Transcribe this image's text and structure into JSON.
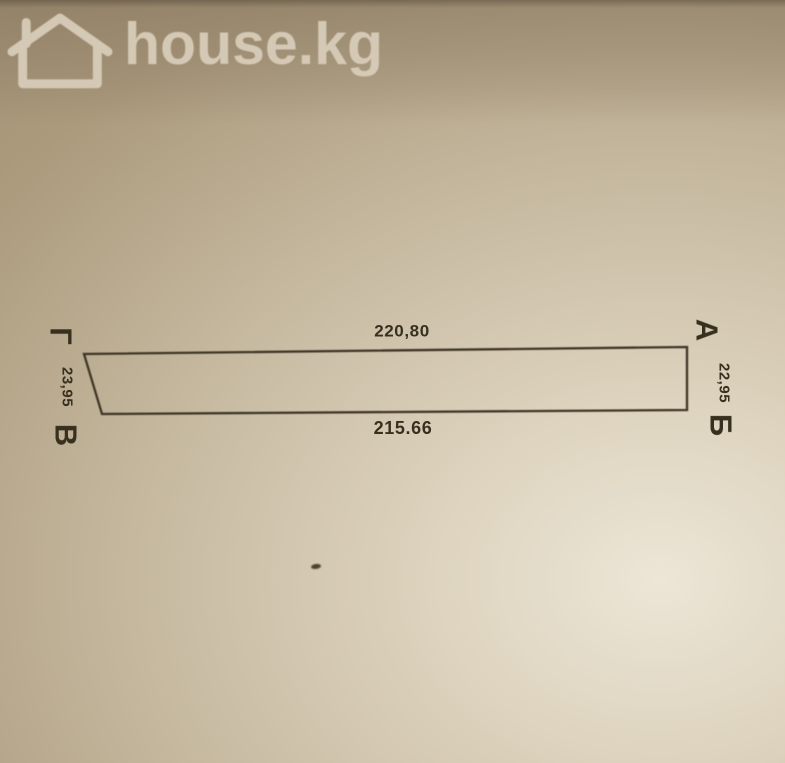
{
  "watermark": {
    "brand": "house.kg",
    "icon": "house-outline-icon",
    "color": "#d9cebb"
  },
  "diagram": {
    "type": "land-plot-survey-sketch",
    "line_color": "#3e3526",
    "corners": [
      {
        "label": "Г",
        "position": "top-left"
      },
      {
        "label": "А",
        "position": "top-right"
      },
      {
        "label": "Б",
        "position": "bottom-right"
      },
      {
        "label": "В",
        "position": "bottom-left"
      }
    ],
    "dimensions": {
      "top": "220,80",
      "bottom": "215.66",
      "left": "23,95",
      "right": "22,95"
    }
  }
}
